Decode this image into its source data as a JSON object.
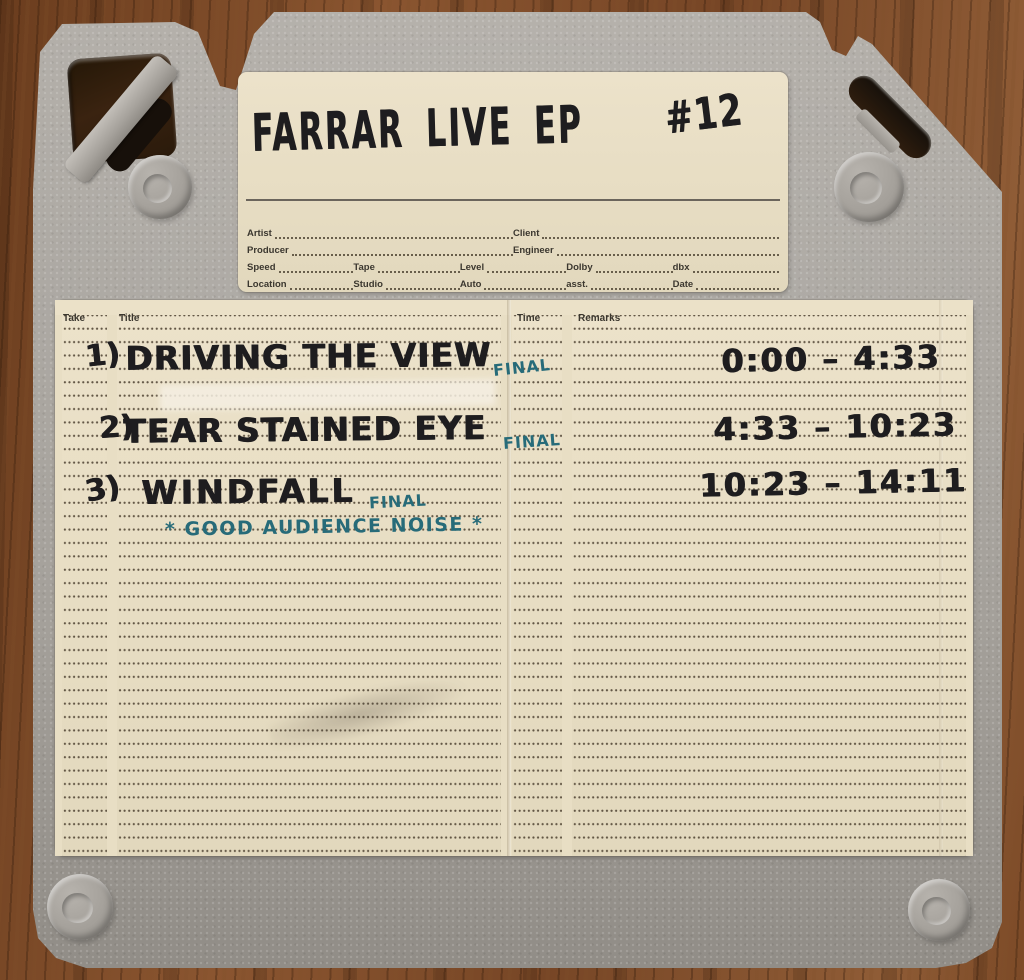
{
  "label_card": {
    "title": "FARRAR LIVE EP",
    "reel_number": "#12",
    "form_rows": [
      {
        "cells": [
          {
            "label": "Artist"
          },
          {
            "label": "Client"
          }
        ]
      },
      {
        "cells": [
          {
            "label": "Producer"
          },
          {
            "label": "Engineer"
          }
        ]
      },
      {
        "cells": [
          {
            "label": "Speed"
          },
          {
            "label": "Tape"
          },
          {
            "label": "Level"
          },
          {
            "label": "Dolby"
          },
          {
            "label": "dbx"
          }
        ]
      },
      {
        "cells": [
          {
            "label": "Location"
          },
          {
            "label": "Studio"
          },
          {
            "label": "Auto"
          },
          {
            "label": "asst."
          },
          {
            "label": "Date"
          }
        ]
      }
    ]
  },
  "log_card": {
    "headers": {
      "take": "Take",
      "title": "Title",
      "time": "Time",
      "remarks": "Remarks"
    },
    "tracks": [
      {
        "num": "1)",
        "title": "DRIVING THE VIEW",
        "status": "FINAL",
        "time": "0:00 – 4:33"
      },
      {
        "num": "2)",
        "title": "TEAR STAINED EYE",
        "status": "FINAL",
        "time": "4:33 – 10:23"
      },
      {
        "num": "3)",
        "title": "WINDFALL",
        "status": "FINAL",
        "time": "10:23 – 14:11"
      }
    ],
    "note": "* GOOD AUDIENCE NOISE *"
  },
  "colors": {
    "ink_black": "#1e1d1f",
    "ink_teal": "#276b79",
    "card_cream": "#e9dfc6",
    "case_gray": "#a8a49e",
    "wood_brown": "#7c4a27"
  }
}
